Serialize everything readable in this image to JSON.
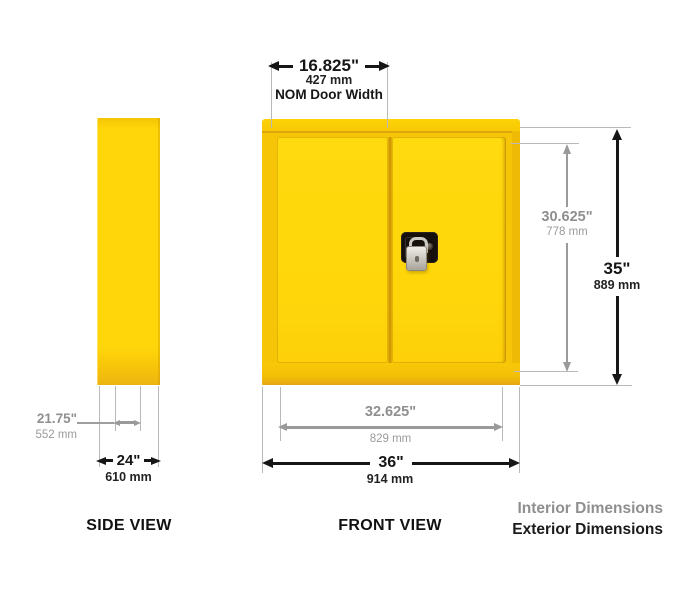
{
  "colors": {
    "cabinet_yellow": "#FFD60A",
    "interior_dimension_gray": "#8F8F8F",
    "exterior_dimension_black": "#161616"
  },
  "side_view": {
    "label": "SIDE VIEW",
    "interior_depth": {
      "inches": "21.75\"",
      "mm": "552 mm"
    },
    "exterior_depth": {
      "inches": "24\"",
      "mm": "610 mm"
    }
  },
  "front_view": {
    "label": "FRONT VIEW",
    "nom_door_width": {
      "inches": "16.825\"",
      "mm": "427 mm",
      "caption": "NOM Door Width"
    },
    "interior_width": {
      "inches": "32.625\"",
      "mm": "829 mm"
    },
    "exterior_width": {
      "inches": "36\"",
      "mm": "914 mm"
    },
    "interior_height": {
      "inches": "30.625\"",
      "mm": "778 mm"
    },
    "exterior_height": {
      "inches": "35\"",
      "mm": "889 mm"
    }
  },
  "legend": {
    "interior_label": "Interior Dimensions",
    "exterior_label": "Exterior Dimensions"
  }
}
